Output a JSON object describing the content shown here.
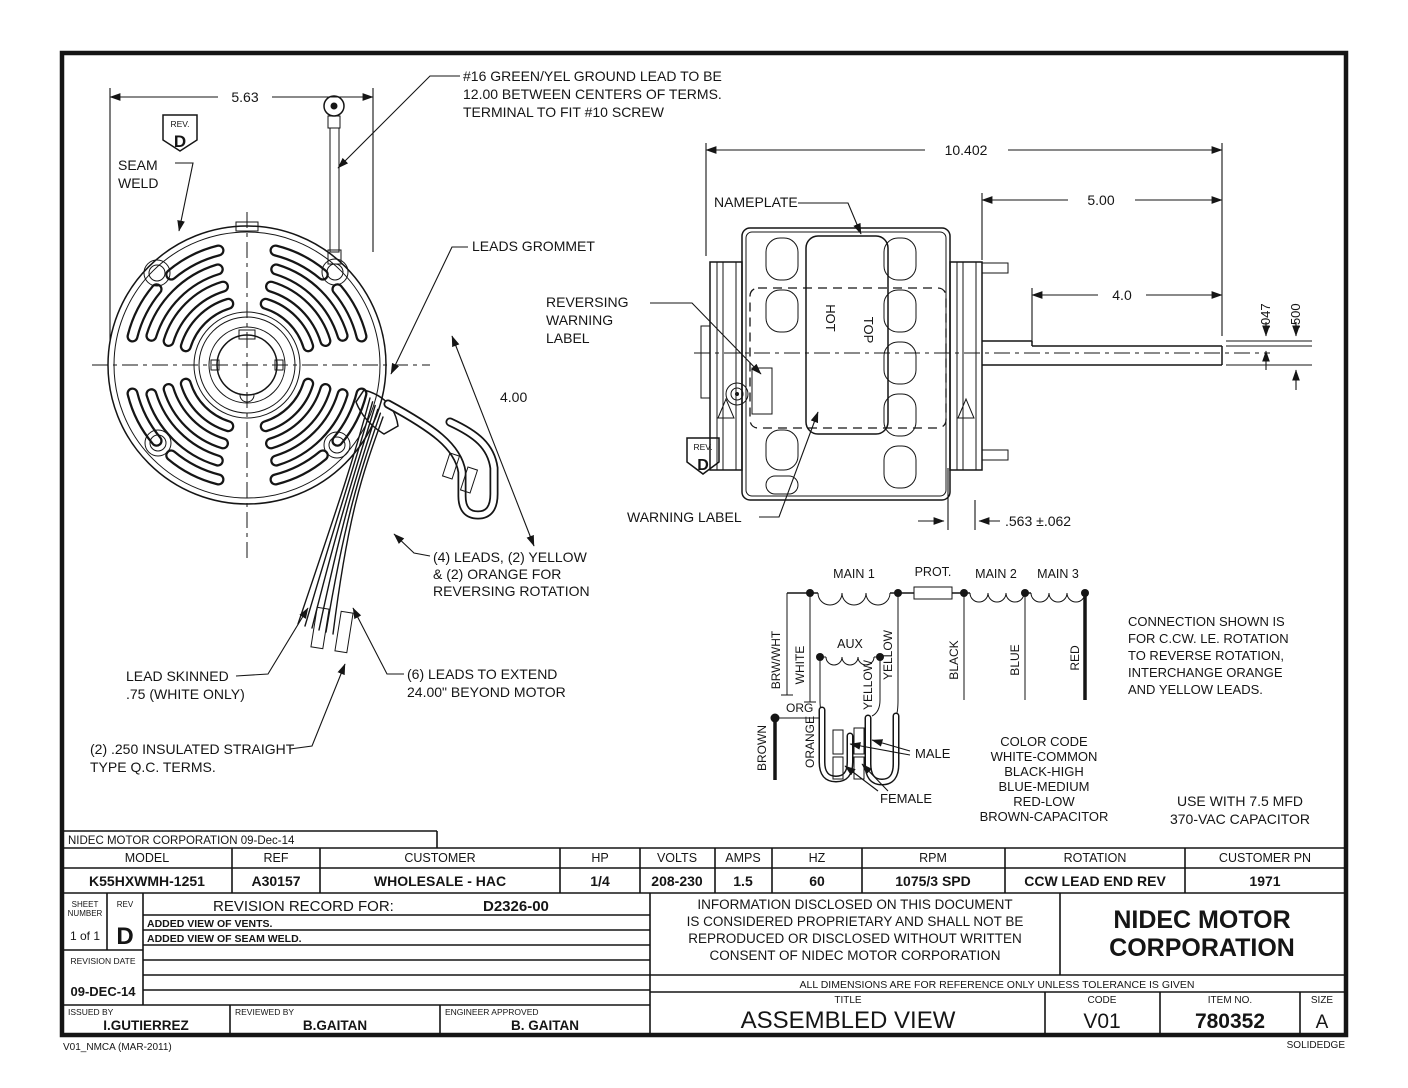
{
  "drawing": {
    "note": "NIDEC MOTOR CORPORATION 09-Dec-14",
    "annotations": {
      "ground_l1": "#16 GREEN/YEL GROUND LEAD TO BE",
      "ground_l2": "12.00 BETWEEN CENTERS OF TERMS.",
      "ground_l3": "TERMINAL TO FIT #10 SCREW",
      "seam_l1": "SEAM",
      "seam_l2": "WELD",
      "leads_grommet": "LEADS GROMMET",
      "nameplate": "NAMEPLATE",
      "reversing_l1": "REVERSING",
      "reversing_l2": "WARNING",
      "reversing_l3": "LABEL",
      "warning_label": "WARNING LABEL",
      "four_l1": "(4) LEADS, (2) YELLOW",
      "four_l2": "& (2) ORANGE FOR",
      "four_l3": "REVERSING ROTATION",
      "skinned_l1": "LEAD    SKINNED",
      "skinned_l2": ".75 (WHITE ONLY)",
      "six_l1": "(6) LEADS TO EXTEND",
      "six_l2": "24.00\" BEYOND MOTOR",
      "qc_l1": "(2) .250 INSULATED STRAIGHT",
      "qc_l2": "TYPE Q.C. TERMS.",
      "rev_caption": "REV.",
      "rev_letter": "D",
      "top_text": "TOP",
      "hot_text": "HOT"
    },
    "dims": {
      "d563": "5.63",
      "d10402": "10.402",
      "d500": "5.00",
      "d40": "4.0",
      "d047": ".047",
      "d500b": ".500",
      "d400": "4.00",
      "d563b": ".563 ±.062"
    },
    "schematic": {
      "main1": "MAIN 1",
      "prot": "PROT.",
      "main2": "MAIN 2",
      "main3": "MAIN 3",
      "aux": "AUX",
      "brwwht": "BRW/WHT",
      "white": "WHITE",
      "yellow": "YELLOW",
      "black": "BLACK",
      "blue": "BLUE",
      "red": "RED",
      "org": "ORG",
      "orange": "ORANGE",
      "brown": "BROWN",
      "male": "MALE",
      "female": "FEMALE",
      "color_code": [
        "COLOR CODE",
        "WHITE-COMMON",
        "BLACK-HIGH",
        "BLUE-MEDIUM",
        "RED-LOW",
        "BROWN-CAPACITOR"
      ],
      "connection": [
        "CONNECTION SHOWN IS",
        "FOR C.CW. LE. ROTATION",
        "TO REVERSE ROTATION,",
        "INTERCHANGE ORANGE",
        "AND YELLOW LEADS."
      ],
      "capacitor": [
        "USE WITH 7.5 MFD",
        "370-VAC CAPACITOR"
      ]
    },
    "spec": {
      "headers": [
        "MODEL",
        "REF",
        "CUSTOMER",
        "HP",
        "VOLTS",
        "AMPS",
        "HZ",
        "RPM",
        "ROTATION",
        "CUSTOMER PN"
      ],
      "values": [
        "K55HXWMH-1251",
        "A30157",
        "WHOLESALE - HAC",
        "1/4",
        "208-230",
        "1.5",
        "60",
        "1075/3 SPD",
        "CCW LEAD END REV",
        "1971"
      ]
    },
    "revision": {
      "sheet_l1": "SHEET",
      "sheet_l2": "NUMBER",
      "sheet_value": "1 of 1",
      "rev_label": "REV",
      "rev_value": "D",
      "record_label": "REVISION RECORD FOR:",
      "record_value": "D2326-00",
      "entry1": "ADDED VIEW OF VENTS.",
      "entry2": "ADDED VIEW OF SEAM WELD.",
      "date_label": "REVISION DATE",
      "date_value": "09-DEC-14"
    },
    "titleblock": {
      "prop_l1": "INFORMATION DISCLOSED ON THIS DOCUMENT",
      "prop_l2": "IS CONSIDERED PROPRIETARY AND SHALL NOT BE",
      "prop_l3": "REPRODUCED OR DISCLOSED WITHOUT WRITTEN",
      "prop_l4": "CONSENT OF NIDEC MOTOR CORPORATION",
      "company_l1": "NIDEC MOTOR",
      "company_l2": "CORPORATION",
      "tolerance": "ALL DIMENSIONS ARE FOR REFERENCE ONLY UNLESS TOLERANCE IS GIVEN",
      "title_label": "TITLE",
      "title_value": "ASSEMBLED VIEW",
      "code_label": "CODE",
      "code_value": "V01",
      "item_label": "ITEM NO.",
      "item_value": "780352",
      "size_label": "SIZE",
      "size_value": "A",
      "issued_label": "ISSUED BY",
      "issued_value": "I.GUTIERREZ",
      "reviewed_label": "REVIEWED BY",
      "reviewed_value": "B.GAITAN",
      "approved_label": "ENGINEER APPROVED",
      "approved_value": "B. GAITAN"
    },
    "footer": {
      "left": "V01_NMCA (MAR-2011)",
      "right": "SOLIDEDGE"
    }
  }
}
